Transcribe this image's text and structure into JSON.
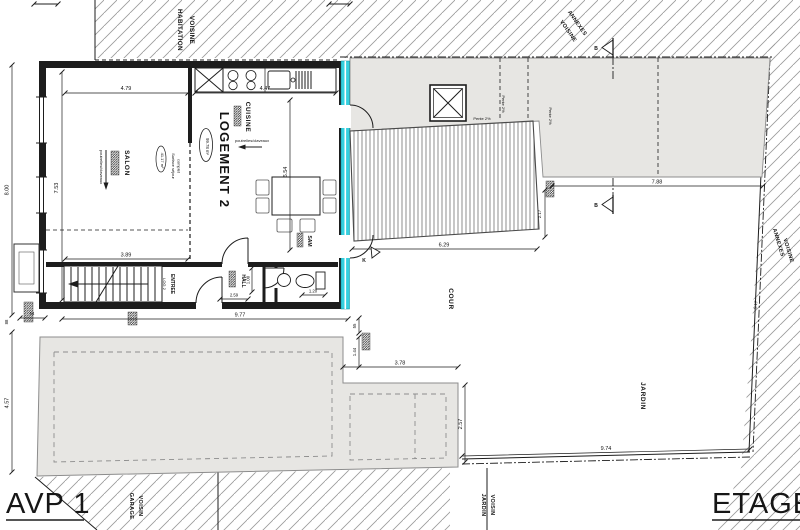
{
  "plan": {
    "titles": {
      "left": "AVP 1",
      "right": "ETAGE"
    },
    "neighbors": {
      "habitation_l1": "HABITATION",
      "habitation_l2": "VOISINE",
      "annexes_top_l1": "ANNEXES",
      "annexes_top_l2": "VOISINE",
      "annexes_right_l1": "ANNEXES",
      "annexes_right_l2": "VOISINE",
      "garage_l1": "GARAGE",
      "garage_l2": "VOISIN",
      "jardin_l1": "JARDIN",
      "jardin_l2": "VOISIN"
    },
    "rooms": {
      "logement": "LOGEMENT 2",
      "logement_area": "99.78 m²",
      "salon": "SALON",
      "cuisine": "CUISINE",
      "hall": "HALL",
      "entree": "ENTREE",
      "entree_sub": "LOG 2",
      "sam": "SAM",
      "cour": "COUR",
      "jardin": "JARDIN"
    },
    "notes": {
      "beams": "poutrelles/claveaux",
      "sejour_l1": "Surface séjour",
      "sejour_l2": "complet",
      "sejour_area": "41.17 m²",
      "pente": "Pente 2%"
    },
    "markers": {
      "section_b": "B",
      "section_k": "K"
    },
    "dims": {
      "d479": "4.79",
      "d447": "4.47",
      "d753": "7.53",
      "d800": "8.00",
      "d654": "6.54",
      "d389": "3.89",
      "d259": "2.59",
      "d100": "1.00",
      "d120": "1.20",
      "d977": "9.77",
      "d54": "54",
      "d88": "88",
      "d457": "4.57",
      "d55": "55",
      "d144": "1.44",
      "d378": "3.78",
      "d257": "2.57",
      "d974": "9.74",
      "d629": "6.29",
      "d788": "7.88",
      "d217": "2.17",
      "d917": "9.17"
    },
    "colors": {
      "highlight": "#35d0df",
      "roof_fill": "#e7e6e3",
      "hatch": "#9a9a9a",
      "line": "#1d1d1d"
    }
  }
}
